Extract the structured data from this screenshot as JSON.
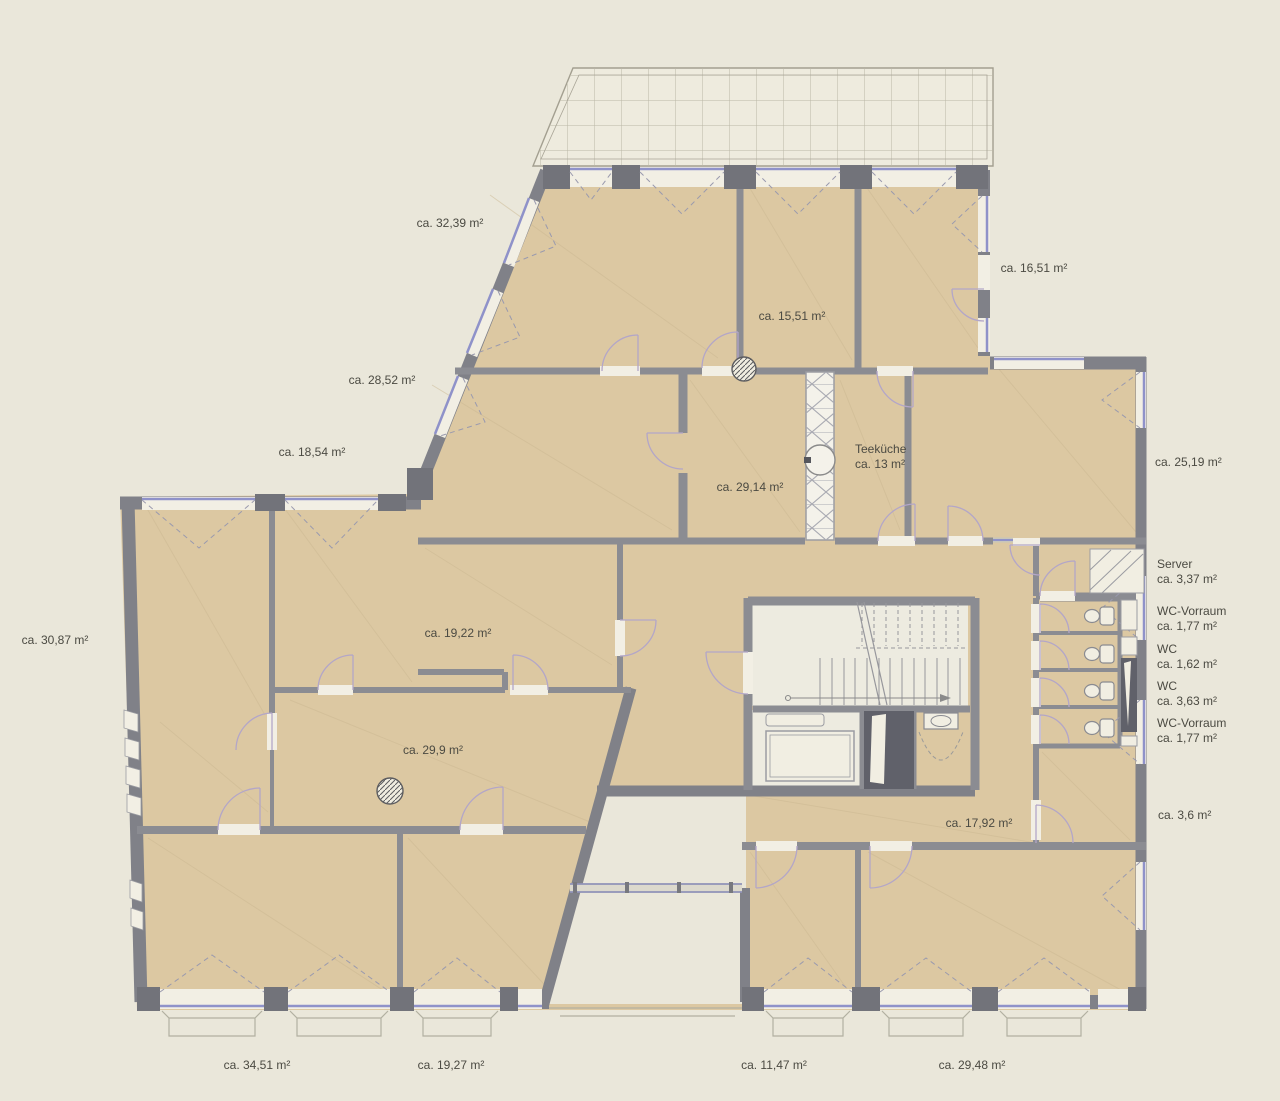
{
  "title": "Grundriss Bürogeschoss",
  "units": "m²",
  "colors": {
    "background": "#eae7da",
    "room_fill": "#dcc8a2",
    "wall": "#808188",
    "pier": "#72737a",
    "window_blue": "#8f92c9",
    "shaft_dark": "#60616a",
    "text": "#4b4a42"
  },
  "floorplan": {
    "labels": [
      {
        "id": "room-32-39",
        "text": "ca. 32,39 m²"
      },
      {
        "id": "terrace-16-51",
        "text": "ca. 16,51 m²"
      },
      {
        "id": "room-15-51",
        "text": "ca. 15,51 m²"
      },
      {
        "id": "room-28-52",
        "text": "ca. 28,52 m²"
      },
      {
        "id": "room-18-54",
        "text": "ca. 18,54 m²"
      },
      {
        "id": "room-25-19",
        "text": "ca. 25,19 m²"
      },
      {
        "id": "teekueche-name",
        "text": "Teeküche"
      },
      {
        "id": "teekueche-area",
        "text": "ca. 13 m²"
      },
      {
        "id": "room-29-14",
        "text": "ca. 29,14 m²"
      },
      {
        "id": "server-name",
        "text": "Server"
      },
      {
        "id": "server-area",
        "text": "ca. 3,37 m²"
      },
      {
        "id": "room-30-87",
        "text": "ca. 30,87 m²"
      },
      {
        "id": "room-19-22",
        "text": "ca. 19,22 m²"
      },
      {
        "id": "wc-vorraum-1-name",
        "text": "WC-Vorraum"
      },
      {
        "id": "wc-vorraum-1-area",
        "text": "ca. 1,77 m²"
      },
      {
        "id": "wc-1-name",
        "text": "WC"
      },
      {
        "id": "wc-1-area",
        "text": "ca. 1,62 m²"
      },
      {
        "id": "wc-2-name",
        "text": "WC"
      },
      {
        "id": "wc-2-area",
        "text": "ca. 3,63 m²"
      },
      {
        "id": "wc-vorraum-2-name",
        "text": "WC-Vorraum"
      },
      {
        "id": "wc-vorraum-2-area",
        "text": "ca. 1,77 m²"
      },
      {
        "id": "room-29-9",
        "text": "ca. 29,9 m²"
      },
      {
        "id": "room-17-92",
        "text": "ca. 17,92 m²"
      },
      {
        "id": "balcony-3-6",
        "text": "ca. 3,6 m²"
      },
      {
        "id": "room-34-51",
        "text": "ca. 34,51 m²"
      },
      {
        "id": "room-19-27",
        "text": "ca. 19,27 m²"
      },
      {
        "id": "room-11-47",
        "text": "ca. 11,47 m²"
      },
      {
        "id": "room-29-48",
        "text": "ca. 29,48 m²"
      }
    ]
  }
}
